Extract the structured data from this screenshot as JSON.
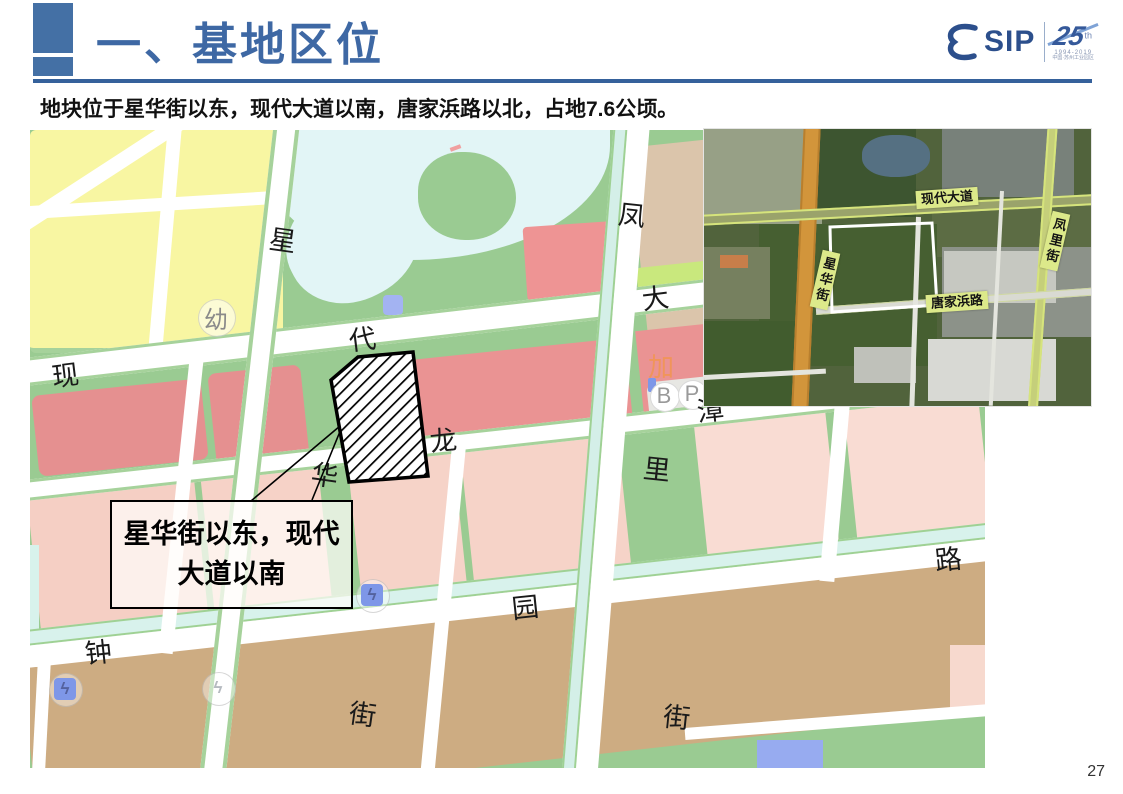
{
  "header": {
    "title": "一、基地区位",
    "logo": {
      "sip": "SIP",
      "anniversary_number": "25",
      "anniversary_sup": "th",
      "anniversary_years": "1994-2019",
      "anniversary_org": "中国·苏州工业园区"
    }
  },
  "intro_text": "地块位于星华街以东，现代大道以南，唐家浜路以北，占地7.6公顷。",
  "page_number": "27",
  "vector_map": {
    "callout": {
      "line1": "星华街以东，现代",
      "line2": "大道以南"
    },
    "street_chars": [
      {
        "t": "星"
      },
      {
        "t": "华"
      },
      {
        "t": "街"
      },
      {
        "t": "现"
      },
      {
        "t": "代"
      },
      {
        "t": "大"
      },
      {
        "t": "凤"
      },
      {
        "t": "里"
      },
      {
        "t": "街"
      },
      {
        "t": "龙"
      },
      {
        "t": "漳"
      },
      {
        "t": "钟"
      },
      {
        "t": "园"
      },
      {
        "t": "路"
      }
    ],
    "poi_labels": [
      {
        "t": "幼"
      },
      {
        "t": "加"
      },
      {
        "t": "B"
      },
      {
        "t": "P"
      }
    ],
    "icons": {
      "charging_bolt": "ϟ"
    }
  },
  "satellite_map": {
    "road_labels": [
      {
        "label": "现代大道"
      },
      {
        "label": "凤里街"
      },
      {
        "label": "星华街"
      },
      {
        "label": "唐家浜路"
      }
    ]
  },
  "colors": {
    "title_blue": "#3E68A4",
    "rule_blue": "#35619B",
    "map_green": "#9ACB92",
    "parcel_yellow": "#F8F6A2",
    "parcel_red": "#EA9393",
    "parcel_pink": "#F5CFC4",
    "parcel_tan": "#CDAC82",
    "water_cyan": "#E2F5F6",
    "canal_cyan": "#D8F2EC",
    "sat_label_bg": "#DCE98A"
  }
}
